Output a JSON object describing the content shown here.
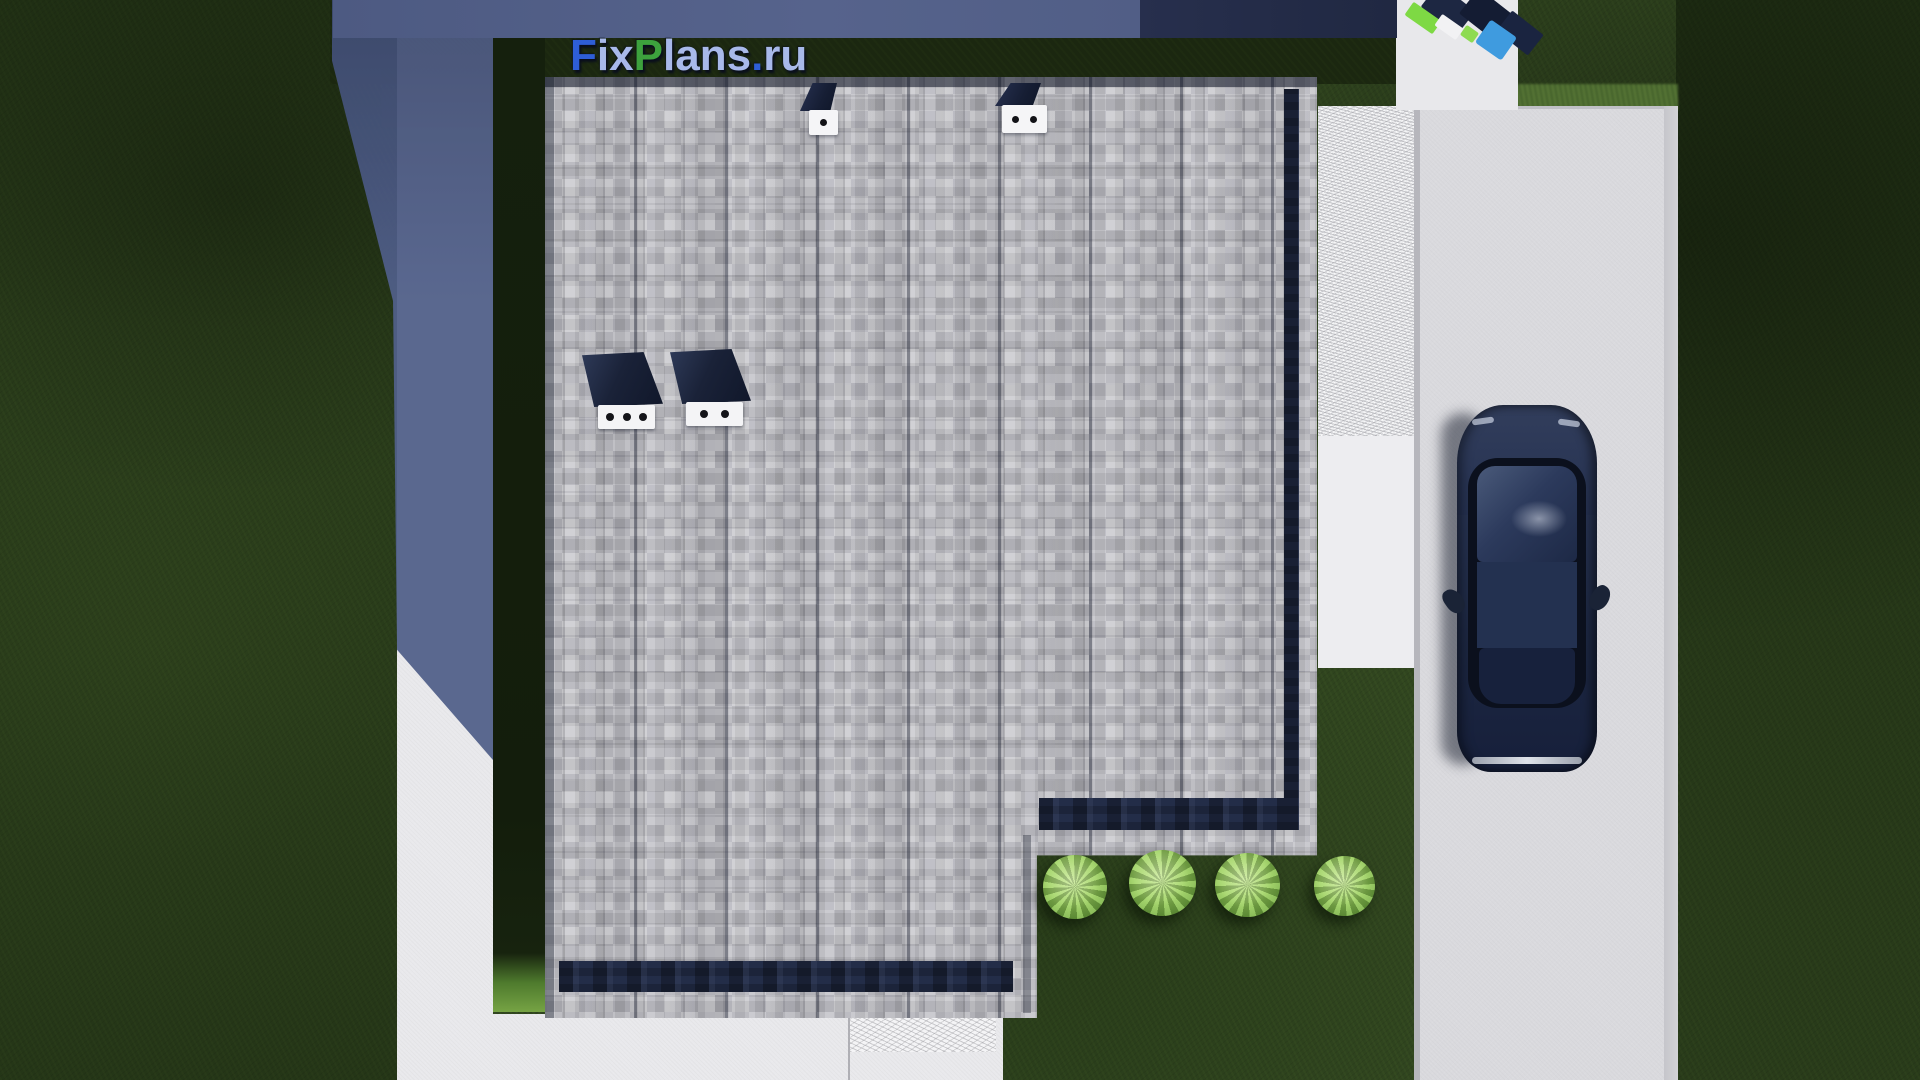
{
  "logo": {
    "text": "FixPlans.ru",
    "letters": [
      {
        "ch": "F",
        "color": "#2e5ed6"
      },
      {
        "ch": "i",
        "color": "#a8b9ea"
      },
      {
        "ch": "x",
        "color": "#a8b9ea"
      },
      {
        "ch": "P",
        "color": "#3da23d"
      },
      {
        "ch": "l",
        "color": "#a8b9ea"
      },
      {
        "ch": "a",
        "color": "#a8b9ea"
      },
      {
        "ch": "n",
        "color": "#a8b9ea"
      },
      {
        "ch": "s",
        "color": "#a8b9ea"
      },
      {
        "ch": ".",
        "color": "#2e5ed6"
      },
      {
        "ch": "r",
        "color": "#a8b9ea"
      },
      {
        "ch": "u",
        "color": "#a8b9ea"
      }
    ]
  },
  "scene": {
    "type": "aerial-top-down-3d-render-of-house-plot",
    "house_roof": {
      "material": "gray-shingles",
      "edge_color": "#232d48",
      "shape": "rectangle-with-notch-at-bottom-right",
      "chimneys": [
        {
          "position": "mid-left",
          "face_dots": 3
        },
        {
          "position": "mid-left-2",
          "face_dots": 2
        }
      ],
      "vents": [
        {
          "position": "top-center-left",
          "face_dots": 1
        },
        {
          "position": "top-center-right",
          "face_dots": 2
        }
      ]
    },
    "bushes": {
      "count": 4,
      "color": "#9fd162",
      "location": "in-notch-right-of-house"
    },
    "car": {
      "color": "#1d2843",
      "location": "driveway-right",
      "orientation": "nose-down"
    },
    "colors": {
      "grass": "#30451f",
      "grass_shaded": "#1b2710",
      "roof": "#b9b9bf",
      "walkway": "#e9e9ec",
      "driveway": "#dadade",
      "cast_shadow": "#51608a",
      "neighbor_blue_block": "#3f9bdf",
      "neighbor_lime_block": "#7ed944"
    }
  }
}
